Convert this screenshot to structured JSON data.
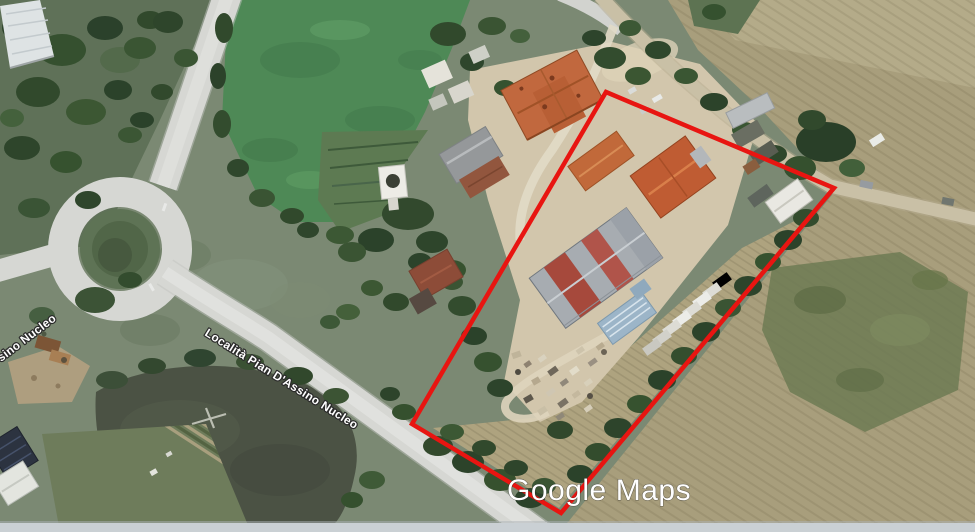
{
  "map": {
    "type": "satellite-view",
    "watermark": {
      "brand": "Google",
      "product": "Maps"
    },
    "road_labels": {
      "main": "Località Pian D'Assino Nucleo",
      "left_partial": "sino Nucleo"
    }
  },
  "overlay": {
    "label": "highlighted parcel boundary",
    "points": "606,92 834,188 561,513 412,424",
    "color": "#e81511",
    "stroke_width": 4.5
  },
  "palette": {
    "terrain": "#7b8973",
    "woodland": "#2f4630",
    "field_green": "#4e8956",
    "farmland": "#a89e7c",
    "plowed_field": "#4b5244",
    "road": "#d6d7d3",
    "dirt_road": "#c9c0a6",
    "roof_orange": "#c1683e",
    "roof_rust": "#a6493c",
    "roof_gray": "#a7acb1",
    "roof_blue": "#9cb5c8",
    "boundary_red": "#e81511",
    "bottom_strip": "#cad0d4"
  }
}
